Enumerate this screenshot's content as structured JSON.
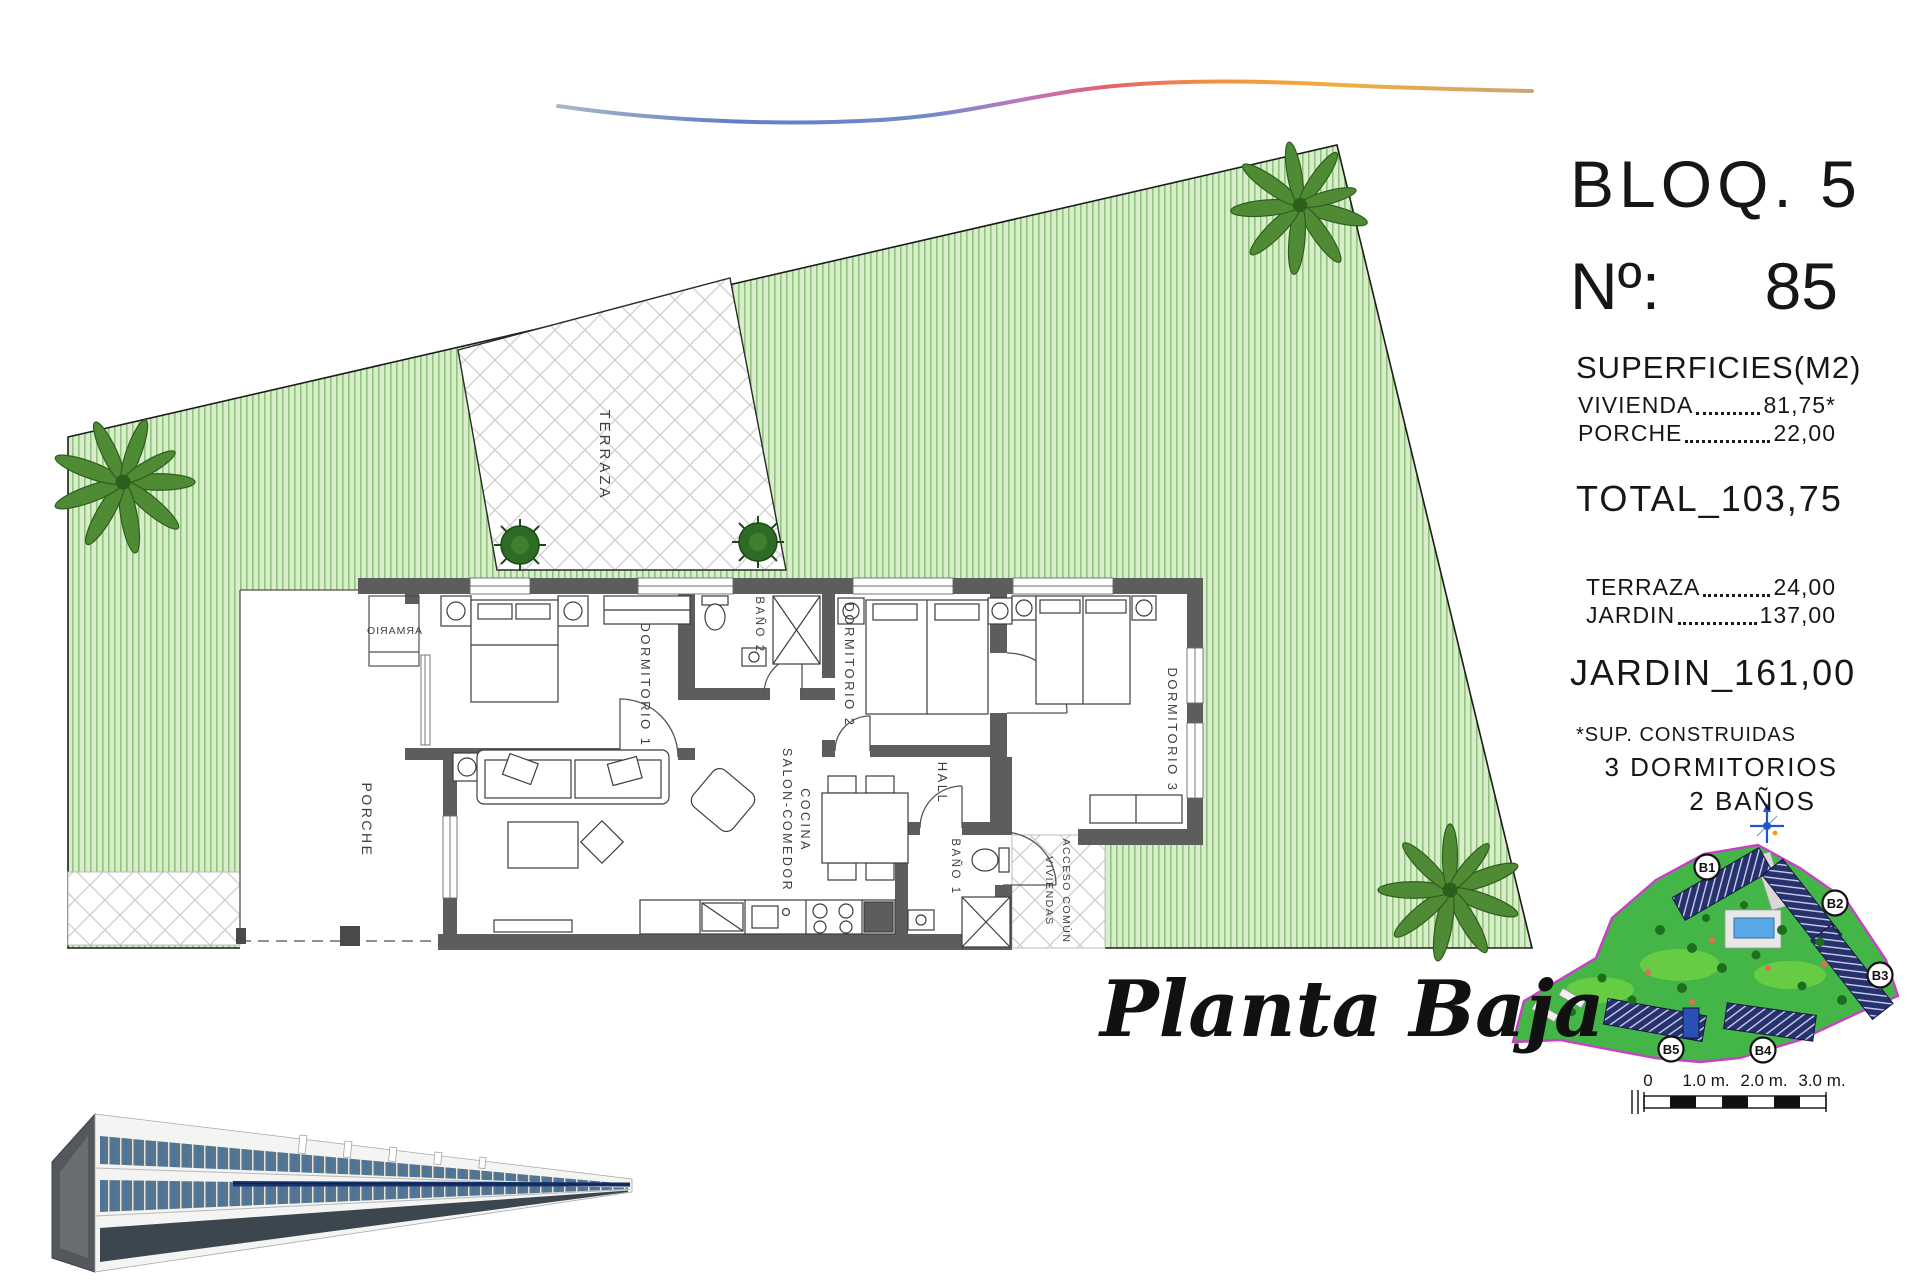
{
  "panel": {
    "block_title": "BLOQ. 5",
    "unit_label": "Nº:",
    "unit_value": "85",
    "surfaces_title": "SUPERFICIES(M2)",
    "surfaces": [
      {
        "label": "VIVIENDA",
        "value": "81,75*"
      },
      {
        "label": "PORCHE",
        "value": "22,00"
      }
    ],
    "total": {
      "label": "TOTAL",
      "separator": "_",
      "value": "103,75"
    },
    "outdoor": [
      {
        "label": "TERRAZA",
        "value": "24,00"
      },
      {
        "label": "JARDIN",
        "value": "137,00"
      }
    ],
    "garden_total": {
      "label": "JARDIN",
      "separator": "_",
      "value": "161,00"
    },
    "footnote": "*SUP. CONSTRUIDAS",
    "features": [
      "3 DORMITORIOS",
      "2 BAÑOS"
    ],
    "site_map_labels": [
      "B1",
      "B2",
      "B3",
      "B4",
      "B5"
    ],
    "scale_labels": [
      "0",
      "1.0 m.",
      "2.0 m.",
      "3.0 m."
    ]
  },
  "plan": {
    "title": "Planta Baja",
    "rooms": {
      "terraza": "TERRAZA",
      "porche": "PORCHE",
      "armario": "ARMARIO",
      "dormitorio1": "DORMITORIO 1",
      "bano2": "BAÑO 2",
      "dormitorio2": "DORMITORIO 2",
      "hall": "HALL",
      "dormitorio3": "DORMITORIO 3",
      "salon_line1": "SALON-COMEDOR",
      "salon_line2": "COCINA",
      "bano1": "BAÑO 1",
      "acceso_line1": "ACCESO COMÚN",
      "acceso_line2": "VIVIENDAS"
    }
  },
  "colors": {
    "garden_fill": "#d9edcb",
    "garden_stripe": "#8fc47e",
    "wall_gray": "#5d5d5d",
    "site_plan_green": "#44b648",
    "site_plan_border": "#c93fc9",
    "building_navy": "#26316e",
    "pool_blue": "#5aa8e8",
    "accent_navy": "#16336e"
  }
}
